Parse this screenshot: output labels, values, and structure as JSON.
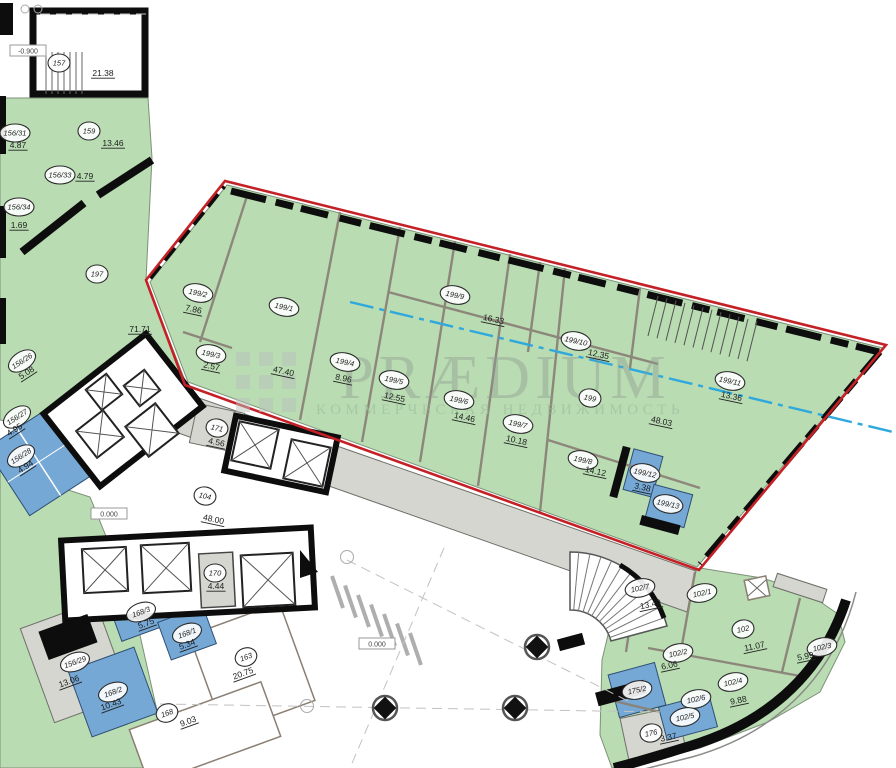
{
  "watermark": {
    "brand": "PRÆDIUM",
    "tagline": "КОММЕРЧЕСКАЯ НЕДВИЖИМОСТЬ"
  },
  "colors": {
    "green": "#b9dcb2",
    "blue": "#76a8d6",
    "gray": "#d6d6d0",
    "red": "#c42127",
    "cyan": "#2fa8dd"
  },
  "levels": [
    {
      "label": "-0.900",
      "x": 28,
      "y": 51
    },
    {
      "label": "0.000",
      "x": 109,
      "y": 514
    },
    {
      "label": "0.000",
      "x": 377,
      "y": 644
    }
  ],
  "rooms": [
    {
      "id": "157",
      "area": "21.38",
      "cx": 59,
      "cy": 63,
      "ax": 103,
      "ay": 76,
      "rot": 0
    },
    {
      "id": "159",
      "area": "13.46",
      "cx": 89,
      "cy": 131,
      "ax": 113,
      "ay": 146,
      "rot": 0
    },
    {
      "id": "156/31",
      "area": "4.87",
      "cx": 15,
      "cy": 133,
      "ax": 18,
      "ay": 148,
      "rot": 0
    },
    {
      "id": "156/33",
      "area": "4.79",
      "cx": 60,
      "cy": 175,
      "ax": 85,
      "ay": 179,
      "rot": 0
    },
    {
      "id": "156/34",
      "area": "1.69",
      "cx": 19,
      "cy": 207,
      "ax": 19,
      "ay": 228,
      "rot": 0
    },
    {
      "id": "197",
      "area": "71.71",
      "cx": 97,
      "cy": 274,
      "ax": 140,
      "ay": 332,
      "rot": 0
    },
    {
      "id": "199/2",
      "area": "7.86",
      "cx": 198,
      "cy": 293,
      "ax": 193,
      "ay": 312,
      "rot": 12
    },
    {
      "id": "199/3",
      "area": "2.57",
      "cx": 211,
      "cy": 354,
      "ax": 211,
      "ay": 369,
      "rot": 12
    },
    {
      "id": "156/26",
      "area": "5.08",
      "cx": 22,
      "cy": 361,
      "ax": 28,
      "ay": 375,
      "rot": -33
    },
    {
      "id": "156/27",
      "area": "4.95",
      "cx": 17,
      "cy": 417,
      "ax": 16,
      "ay": 432,
      "rot": -33
    },
    {
      "id": "156/28",
      "area": "4.94",
      "cx": 21,
      "cy": 456,
      "ax": 27,
      "ay": 469,
      "rot": -33
    },
    {
      "id": "171",
      "area": "4.56",
      "cx": 217,
      "cy": 428,
      "ax": 216,
      "ay": 445,
      "rot": 12
    },
    {
      "id": "199/1",
      "area": "47.40",
      "cx": 284,
      "cy": 307,
      "ax": 283,
      "ay": 374,
      "rot": 12
    },
    {
      "id": "199/4",
      "area": "8.96",
      "cx": 345,
      "cy": 362,
      "ax": 343,
      "ay": 381,
      "rot": 12
    },
    {
      "id": "199/5",
      "area": "12.55",
      "cx": 394,
      "cy": 380,
      "ax": 394,
      "ay": 400,
      "rot": 12
    },
    {
      "id": "199/9",
      "area": "16.33",
      "cx": 455,
      "cy": 295,
      "ax": 493,
      "ay": 322,
      "rot": 12
    },
    {
      "id": "199/6",
      "area": "14.46",
      "cx": 459,
      "cy": 400,
      "ax": 464,
      "ay": 420,
      "rot": 12
    },
    {
      "id": "199/7",
      "area": "10.18",
      "cx": 518,
      "cy": 424,
      "ax": 516,
      "ay": 443,
      "rot": 12
    },
    {
      "id": "199/10",
      "area": "12.35",
      "cx": 576,
      "cy": 341,
      "ax": 598,
      "ay": 357,
      "rot": 12
    },
    {
      "id": "199",
      "area": "48.03",
      "cx": 590,
      "cy": 398,
      "ax": 661,
      "ay": 424,
      "rot": 12
    },
    {
      "id": "199/11",
      "area": "13.36",
      "cx": 730,
      "cy": 381,
      "ax": 731,
      "ay": 399,
      "rot": 12
    },
    {
      "id": "199/8",
      "area": "14.12",
      "cx": 583,
      "cy": 460,
      "ax": 595,
      "ay": 474,
      "rot": 12
    },
    {
      "id": "199/12",
      "area": "3.38",
      "cx": 645,
      "cy": 473,
      "ax": 642,
      "ay": 490,
      "rot": 12
    },
    {
      "id": "199/13",
      "area": "",
      "cx": 668,
      "cy": 504,
      "ax": 0,
      "ay": 0,
      "rot": 12
    },
    {
      "id": "104",
      "area": "48.00",
      "cx": 205,
      "cy": 496,
      "ax": 213,
      "ay": 522,
      "rot": 12
    },
    {
      "id": "170",
      "area": "4.44",
      "cx": 215,
      "cy": 573,
      "ax": 216,
      "ay": 589,
      "rot": 0
    },
    {
      "id": "168/3",
      "area": "5.75",
      "cx": 141,
      "cy": 612,
      "ax": 147,
      "ay": 626,
      "rot": -20
    },
    {
      "id": "168/1",
      "area": "5.34",
      "cx": 187,
      "cy": 633,
      "ax": 188,
      "ay": 647,
      "rot": -20
    },
    {
      "id": "156/29",
      "area": "13.06",
      "cx": 75,
      "cy": 662,
      "ax": 70,
      "ay": 684,
      "rot": -20
    },
    {
      "id": "168/2",
      "area": "10.43",
      "cx": 113,
      "cy": 692,
      "ax": 112,
      "ay": 707,
      "rot": -20
    },
    {
      "id": "163",
      "area": "20.75",
      "cx": 246,
      "cy": 657,
      "ax": 244,
      "ay": 676,
      "rot": -20
    },
    {
      "id": "168",
      "area": "9.03",
      "cx": 167,
      "cy": 713,
      "ax": 189,
      "ay": 724,
      "rot": -20
    },
    {
      "id": "175/2",
      "area": "",
      "cx": 637,
      "cy": 690,
      "ax": 0,
      "ay": 0,
      "rot": -12
    },
    {
      "id": "176",
      "area": "3.37",
      "cx": 651,
      "cy": 733,
      "ax": 669,
      "ay": 740,
      "rot": -12
    },
    {
      "id": "102/7",
      "area": "13.49",
      "cx": 640,
      "cy": 588,
      "ax": 651,
      "ay": 607,
      "rot": -12
    },
    {
      "id": "102/1",
      "area": "",
      "cx": 702,
      "cy": 593,
      "ax": 0,
      "ay": 0,
      "rot": -12
    },
    {
      "id": "102",
      "area": "11.07",
      "cx": 743,
      "cy": 629,
      "ax": 755,
      "ay": 649,
      "rot": -12
    },
    {
      "id": "102/3",
      "area": "5.99",
      "cx": 822,
      "cy": 647,
      "ax": 806,
      "ay": 659,
      "rot": -12
    },
    {
      "id": "102/2",
      "area": "6.06",
      "cx": 678,
      "cy": 653,
      "ax": 670,
      "ay": 668,
      "rot": -12
    },
    {
      "id": "102/4",
      "area": "9.88",
      "cx": 733,
      "cy": 682,
      "ax": 739,
      "ay": 703,
      "rot": -12
    },
    {
      "id": "102/6",
      "area": "",
      "cx": 696,
      "cy": 699,
      "ax": 0,
      "ay": 0,
      "rot": -12
    },
    {
      "id": "102/5",
      "area": "",
      "cx": 685,
      "cy": 717,
      "ax": 0,
      "ay": 0,
      "rot": -12
    }
  ]
}
